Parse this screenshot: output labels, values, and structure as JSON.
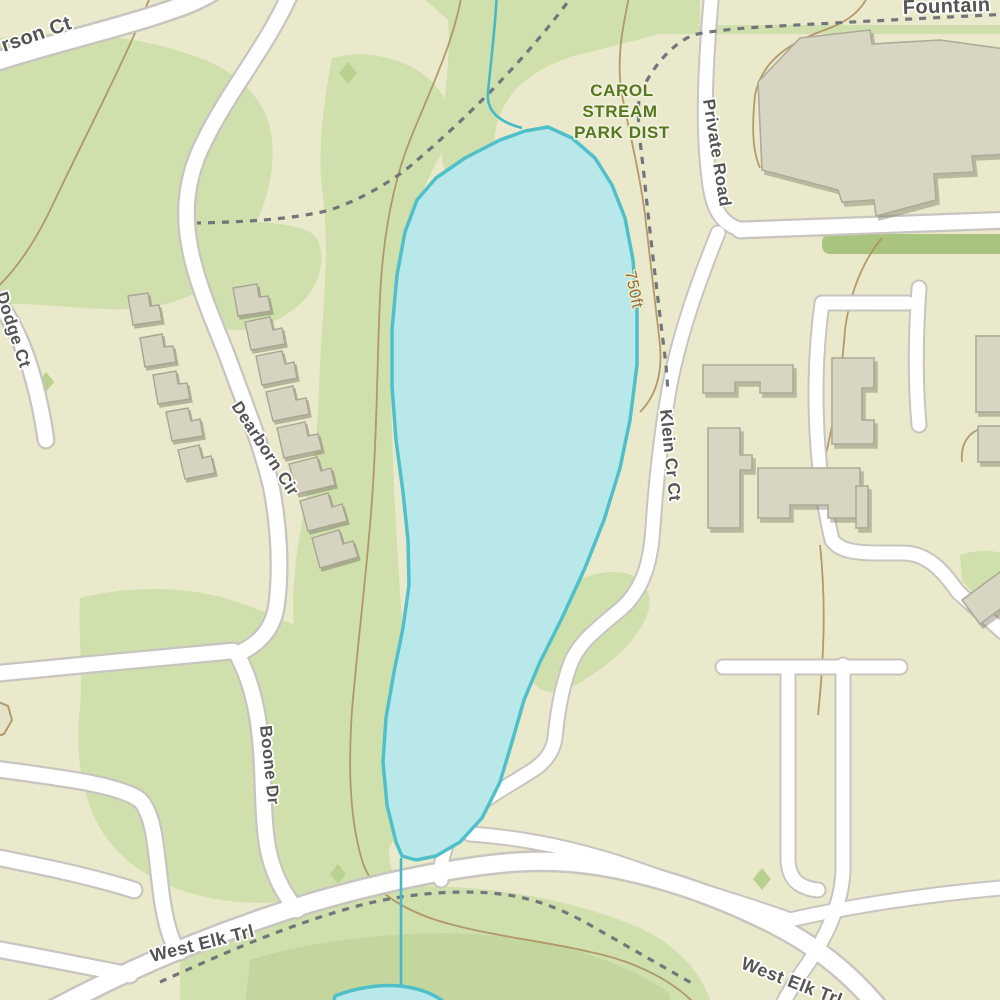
{
  "map": {
    "labels": {
      "street_partial_topleft": "rson Ct",
      "street_partial_topright": "Fountain",
      "private_road": "Private Road",
      "park_district_line1": "CAROL",
      "park_district_line2": "STREAM",
      "park_district_line3": "PARK DIST",
      "contour_elevation": "750ft",
      "klein_cr_ct": "Klein Cr Ct",
      "dodge_ct": "Dodge Ct",
      "dearborn_cir": "Dearborn Cir",
      "boone_dr": "Boone Dr",
      "west_elk_trl": "West Elk Trl",
      "west_elk_trl_2": "West Elk Trl"
    },
    "colors": {
      "terrain": "#ebe9cb",
      "park_green": "#d0e0ac",
      "park_green_dark": "#c3d69e",
      "hedge_green": "#a9c47e",
      "water_fill": "#b9e8ea",
      "water_stroke": "#4fc0c9",
      "road_fill": "#ffffff",
      "road_casing": "#c8c4bf",
      "building_fill": "#d9d5c3",
      "building_stroke": "#aeaa99",
      "contour_line": "#ad9060",
      "trail_dash": "#70767a",
      "street_label": "#4f4f4f",
      "park_label": "#55771d",
      "contour_label": "#8d6e3e"
    }
  }
}
